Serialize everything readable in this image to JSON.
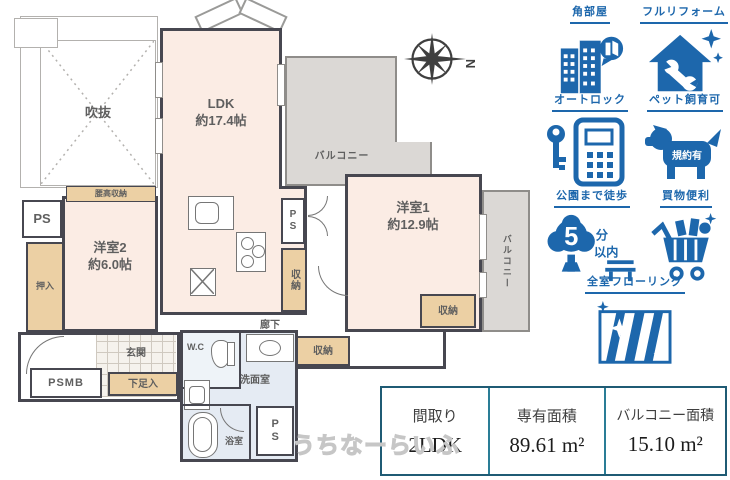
{
  "floor_plan": {
    "void_label": "吹抜",
    "ldk_name": "LDK",
    "ldk_size": "約17.4帖",
    "balcony_top_label": "バルコニー",
    "balcony_right_label": "バルコニー",
    "room1_name": "洋室1",
    "room1_size": "約12.9帖",
    "room2_name": "洋室2",
    "room2_size": "約6.0帖",
    "koshidaka_label": "腰高収納",
    "oshiire_label": "押入",
    "ps_left_label": "PS",
    "ps_kitchen_label": "PS",
    "ps_bath_label": "PS",
    "psmb_label": "PSMB",
    "shunou_kitchen_label": "収納",
    "shunou_hall_label": "収納",
    "shunou_room1_label": "収納",
    "rouka_label": "廊下",
    "genkan_label": "玄関",
    "getabako_label": "下足入",
    "wc_label": "W.C",
    "senmen_label": "洗面室",
    "yokushitsu_label": "浴室"
  },
  "compass": {
    "north": "N"
  },
  "features": {
    "corner_room": "角部屋",
    "full_reform": "フルリフォーム",
    "auto_lock": "オートロック",
    "pet_ok": "ペット飼育可",
    "pet_badge": "規約有",
    "park_walk": "公園まで徒歩",
    "park_minutes": "5",
    "park_minute_unit": "分",
    "park_within": "以内",
    "shopping": "買物便利",
    "flooring": "全室フローリング"
  },
  "summary": {
    "madori_header": "間取り",
    "madori_value": "2LDK",
    "area_header": "専有面積",
    "area_value": "89.61 m²",
    "balcony_header": "バルコニー面積",
    "balcony_value": "15.10 m²"
  },
  "watermark": "うちなーらいふ",
  "colors": {
    "feature_blue": "#1d67ac",
    "wall": "#474750",
    "room_fill": "#fbece4",
    "closet_fill": "#ecd0a4",
    "balcony_fill": "#dbd8d5",
    "wet_area_fill": "#e5ebf3",
    "table_border": "#1f5b74"
  }
}
